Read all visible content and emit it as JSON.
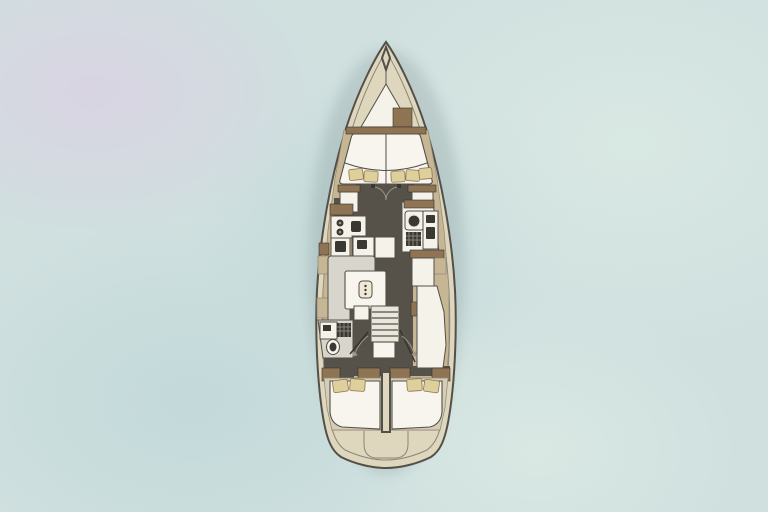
{
  "meta": {
    "description": "Top-down yacht interior deck plan centered on a pale watercolor water background",
    "diagram_type": "sailboat-floor-plan"
  },
  "boat": {
    "parts": [
      "bow-fitting",
      "anchor-locker",
      "bow-hatch",
      "v-berth-cabin",
      "forward-wardrobes",
      "galley",
      "forward-head",
      "salon-settee",
      "salon-table",
      "nav-furniture",
      "companionway-ladder",
      "aft-head",
      "cockpit-walkway",
      "aft-cabin-port",
      "aft-cabin-starboard",
      "stern-helm-seat"
    ]
  },
  "colors": {
    "bg_base": "#cfe0df",
    "bg_mint": "#d9e8e3",
    "bg_lavender": "#d9d4e2",
    "bg_deep": "#c3d9da",
    "hull_fill": "#ded6bd",
    "hull_stroke": "#53504a",
    "deck_line": "#8d8778",
    "side_deck": "#c7b694",
    "wood_trim": "#8e7453",
    "dark_floor": "#56524a",
    "dark_deep": "#35322c",
    "furniture_white": "#f4f2e9",
    "furniture_gray": "#d8d6cc",
    "bed_white": "#f7f5ee",
    "pillow": "#ddd09b",
    "appliance_dark": "#3a3832",
    "accent_light": "#9b968a",
    "shadow": "rgba(95,115,115,0.20)"
  }
}
